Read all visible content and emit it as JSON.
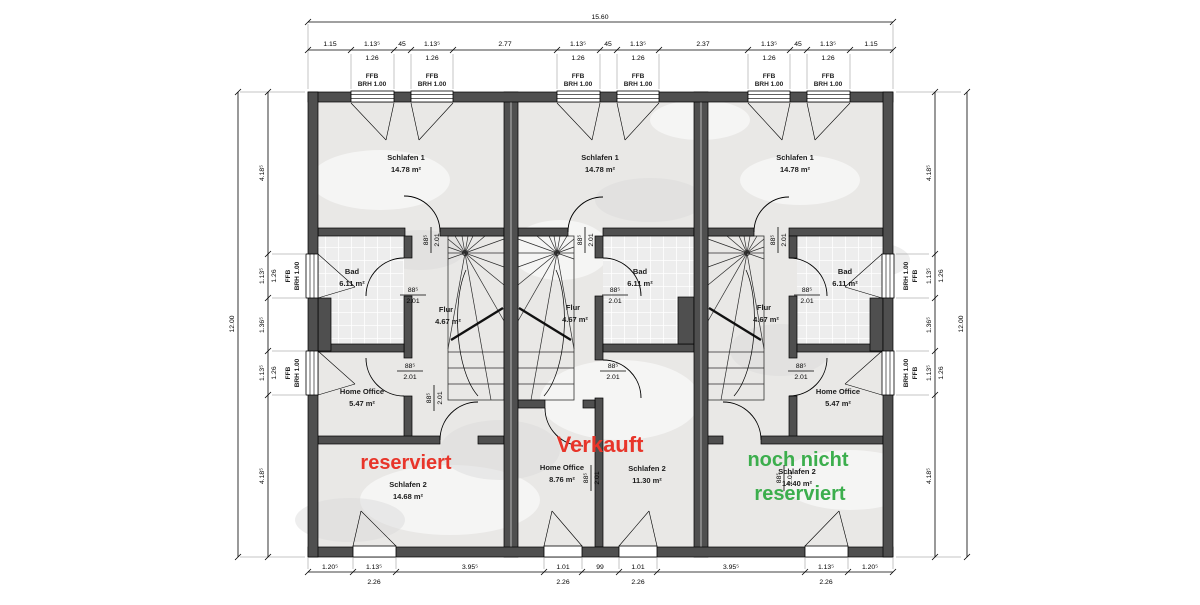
{
  "colors": {
    "red": "#e8352a",
    "green": "#3cae4d",
    "wall": "#4f4f4f",
    "floor": "#e9e8e6"
  },
  "door_label": {
    "w": "88⁵",
    "h": "2.01"
  },
  "window_label": {
    "ffb": "FFB",
    "brh": "BRH 1.00"
  },
  "dims": {
    "top_overall": "15.60",
    "top_chain": [
      "1.15",
      "1.13⁵",
      "45",
      "1.13⁵",
      "2.77",
      "1.13⁵",
      "45",
      "1.13⁵",
      "2.37",
      "1.13⁵",
      "45",
      "1.13⁵",
      "1.15"
    ],
    "top_windows": [
      "1.26",
      "1.26",
      "1.26",
      "1.26",
      "1.26",
      "1.26"
    ],
    "bottom_chain": [
      "1.20⁵",
      "1.13⁵",
      "3.95⁵",
      "1.01",
      "99",
      "1.01",
      "3.95⁵",
      "1.13⁵",
      "1.20⁵"
    ],
    "bottom_windows": [
      "2.26",
      "2.26",
      "2.26",
      "2.26"
    ],
    "side_overall": "12.00",
    "side_chain": [
      "4.18⁵",
      "1.13⁵",
      "1.36⁵",
      "1.13⁵",
      "4.18⁵"
    ],
    "side_windows": [
      "1.26",
      "1.26"
    ]
  },
  "units": [
    {
      "status": "reserviert",
      "schlafen1": {
        "name": "Schlafen 1",
        "area": "14.78 m²"
      },
      "bad": {
        "name": "Bad",
        "area": "6.11 m²"
      },
      "flur": {
        "name": "Flur",
        "area": "4.67 m²"
      },
      "home_office": {
        "name": "Home Office",
        "area": "5.47 m²"
      },
      "schlafen2": {
        "name": "Schlafen 2",
        "area": "14.68 m²"
      }
    },
    {
      "status": "Verkauft",
      "schlafen1": {
        "name": "Schlafen 1",
        "area": "14.78 m²"
      },
      "bad": {
        "name": "Bad",
        "area": "6.11 m²"
      },
      "flur": {
        "name": "Flur",
        "area": "4.67 m²"
      },
      "home_office": {
        "name": "Home Office",
        "area": "8.76 m²"
      },
      "schlafen2": {
        "name": "Schlafen 2",
        "area": "11.30 m²"
      }
    },
    {
      "status_line1": "noch nicht",
      "status_line2": "reserviert",
      "schlafen1": {
        "name": "Schlafen 1",
        "area": "14.78 m²"
      },
      "bad": {
        "name": "Bad",
        "area": "6.11 m²"
      },
      "flur": {
        "name": "Flur",
        "area": "4.67 m²"
      },
      "home_office": {
        "name": "Home Office",
        "area": "5.47 m²"
      },
      "schlafen2": {
        "name": "Schlafen 2",
        "area": "14.40 m²"
      }
    }
  ]
}
